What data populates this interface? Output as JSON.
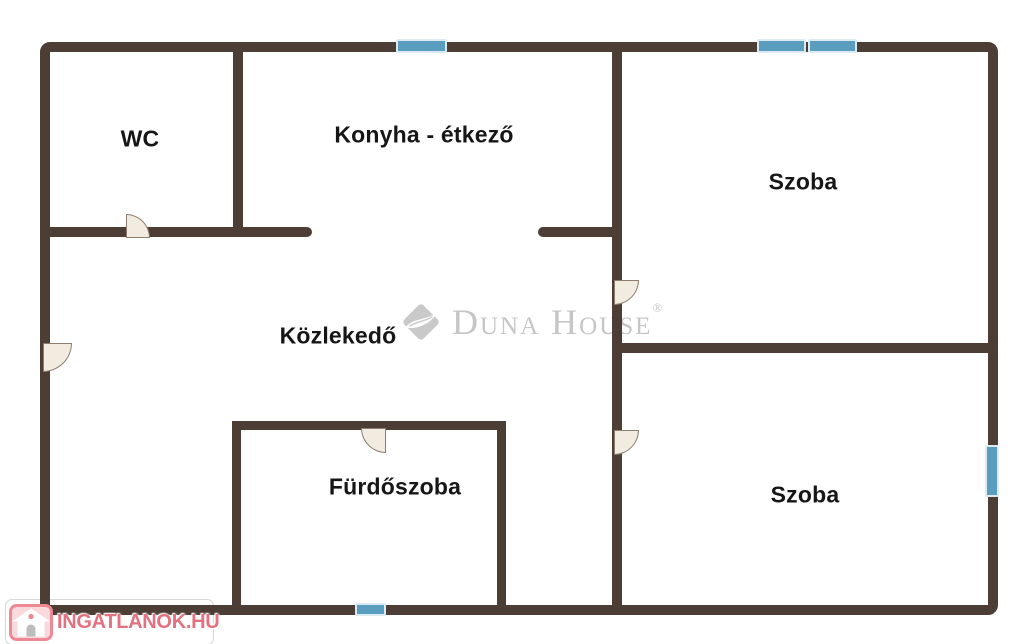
{
  "rooms": {
    "wc": "WC",
    "konyha": "Konyha - étkező",
    "szoba_top": "Szoba",
    "kozlekedo": "Közlekedő",
    "furdoszoba": "Fürdőszoba",
    "szoba_bottom": "Szoba"
  },
  "watermark": {
    "brand": "Duna House",
    "registered": "®"
  },
  "footer": {
    "logo_text": "INGATLANOK.HU"
  },
  "colors": {
    "wall": "#4c3e35",
    "window": "#5b9dbf",
    "door_fill": "#f1ebe0",
    "brand_gray": "#c6c6c6",
    "logo_pink": "#e4717f"
  }
}
